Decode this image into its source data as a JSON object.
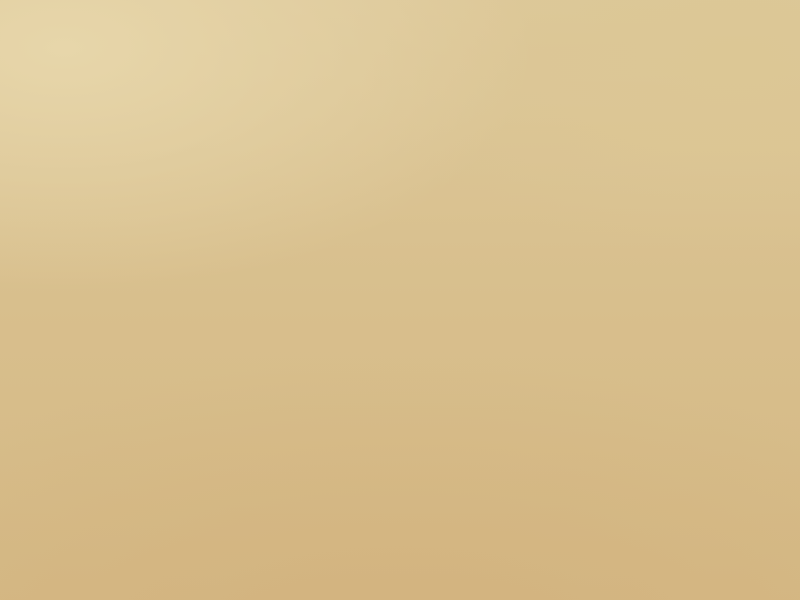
{
  "map": {
    "kind": "aerial-masterplan-rendering",
    "canvas": {
      "w": 800,
      "h": 600
    },
    "palette": {
      "sand": "#d9c290",
      "sand_light": "#e6d4a6",
      "sand_dark": "#c9ad7b",
      "road": "#8e8876",
      "road_light": "#9d947f",
      "track": "#bcae8e",
      "olive": "#74823e",
      "olive_dark": "#5c6b33",
      "lawn": "#8db83b",
      "lawn_bright": "#9cc44a",
      "lawn_pale": "#b9c47e",
      "tree": "#3a5322",
      "tree_dark": "#2c431c",
      "tree_mid": "#4b662c",
      "row_cream": "#e8e2bc",
      "row_shadow": "#a8a87b",
      "building_cream": "#e9e2bb",
      "building_shadow": "#b3a97e",
      "facility_white": "#f1ecd9",
      "court_green": "#5f7034",
      "glass_blue": "#41618c",
      "pool_blue": "#3ea2cf",
      "bloom_pink": "#c887b5",
      "bloom_red": "#a8452f",
      "rust": "#a96a3c",
      "island_green": "#7cab36",
      "shrubs": [
        "#6d7544",
        "#57633a",
        "#7d7a4e",
        "#4a5630",
        "#8a8050",
        "#9a6a40"
      ]
    },
    "desert_patches": [
      [
        640,
        420,
        150,
        140,
        "#cdb17e",
        0.55
      ],
      [
        190,
        515,
        260,
        90,
        "#cfb077",
        0.45
      ],
      [
        540,
        55,
        90,
        130,
        "#e3d2a2",
        0.6
      ],
      [
        765,
        290,
        40,
        220,
        "#cdb17e",
        0.5
      ],
      [
        0,
        330,
        150,
        180,
        "#e0cb9b",
        0.5
      ]
    ],
    "highway": {
      "rail": [
        37,
        0,
        8,
        600
      ],
      "road": [
        49,
        0,
        8,
        600
      ]
    },
    "interchange": {
      "ramps": [
        [
          -20,
          8,
          150,
          5,
          24
        ],
        [
          -22,
          28,
          145,
          5,
          12
        ],
        [
          -18,
          -4,
          125,
          4,
          38
        ],
        [
          -12,
          54,
          118,
          5,
          -16
        ],
        [
          2,
          74,
          100,
          4,
          -33
        ],
        [
          52,
          32,
          70,
          6,
          8
        ]
      ],
      "loops": [
        [
          3,
          12,
          30
        ],
        [
          15,
          40,
          28
        ]
      ]
    },
    "arterial": {
      "rect": [
        58,
        55,
        692,
        10
      ],
      "rot": -0.5
    },
    "roundabout": {
      "x": 718,
      "y": 27,
      "outer": 60,
      "inner": 42,
      "trees": 10
    },
    "roads": [
      [
        157,
        0,
        5,
        58,
        "road",
        0
      ],
      [
        487,
        0,
        5,
        72,
        "road",
        0
      ],
      [
        744,
        0,
        5,
        30,
        "road",
        0
      ],
      [
        775,
        51,
        25,
        6,
        "road",
        0
      ],
      [
        0,
        297,
        38,
        6,
        "road",
        0
      ],
      [
        0,
        497,
        800,
        7,
        "road",
        0
      ],
      [
        157,
        58,
        5,
        442,
        "road_light",
        0
      ],
      [
        328,
        76,
        4,
        424,
        "road_light",
        0
      ],
      [
        487,
        72,
        5,
        428,
        "road_light",
        0
      ],
      [
        581,
        92,
        3,
        192,
        "road_light",
        0
      ],
      [
        643,
        66,
        4,
        218,
        "road_light",
        0
      ],
      [
        698,
        282,
        3,
        218,
        "road_light",
        0
      ],
      [
        750,
        80,
        5,
        426,
        "road",
        1.8
      ],
      [
        157,
        209,
        336,
        4,
        "road_light",
        0
      ],
      [
        487,
        218,
        268,
        4,
        "road_light",
        0
      ],
      [
        157,
        339,
        336,
        5,
        "road_light",
        0
      ],
      [
        487,
        279,
        268,
        5,
        "road_light",
        0
      ]
    ],
    "south_tracks": [
      [
        175,
        505,
        2,
        95
      ],
      [
        331,
        505,
        2,
        95
      ]
    ],
    "islands": [
      [
        486,
        338,
        10
      ],
      [
        578,
        278,
        10
      ],
      [
        325,
        338,
        8
      ]
    ],
    "medians": [
      [
        758,
        474,
        5,
        24,
        2
      ]
    ],
    "pads": [
      [
        160,
        86,
        204,
        130
      ],
      [
        348,
        90,
        116,
        122
      ],
      [
        450,
        94,
        92,
        104
      ],
      [
        578,
        84,
        184,
        138
      ],
      [
        156,
        206,
        184,
        146
      ],
      [
        332,
        210,
        252,
        140
      ],
      [
        580,
        208,
        182,
        140
      ],
      [
        158,
        338,
        176,
        156
      ],
      [
        328,
        344,
        186,
        134
      ],
      [
        498,
        340,
        270,
        154
      ],
      [
        736,
        86,
        18,
        416
      ],
      [
        160,
        462,
        606,
        32
      ],
      [
        164,
        84,
        592,
        16
      ]
    ],
    "tree_lines": [
      [
        80,
        46,
        660,
        10,
        70
      ],
      [
        80,
        66,
        660,
        12,
        80
      ],
      [
        165,
        84,
        590,
        14,
        90
      ],
      [
        160,
        484,
        610,
        14,
        90
      ],
      [
        165,
        464,
        600,
        16,
        60
      ],
      [
        157,
        328,
        335,
        24,
        55
      ],
      [
        487,
        268,
        268,
        24,
        50
      ],
      [
        733,
        85,
        40,
        415,
        80
      ],
      [
        149,
        62,
        18,
        438,
        55
      ],
      [
        479,
        74,
        18,
        426,
        50
      ],
      [
        321,
        78,
        16,
        422,
        45
      ],
      [
        575,
        70,
        12,
        214,
        24
      ],
      [
        637,
        66,
        12,
        218,
        24
      ],
      [
        58,
        128,
        102,
        370,
        80
      ],
      [
        330,
        346,
        182,
        132,
        60
      ],
      [
        336,
        248,
        132,
        58,
        26
      ],
      [
        160,
        506,
        620,
        16,
        36
      ],
      [
        58,
        62,
        10,
        430,
        26
      ],
      [
        700,
        284,
        12,
        214,
        22
      ]
    ],
    "shrub_fields": [
      [
        0,
        0,
        290,
        50,
        50
      ],
      [
        565,
        0,
        235,
        46,
        40
      ],
      [
        60,
        52,
        700,
        34,
        60
      ],
      [
        0,
        60,
        38,
        540,
        50
      ],
      [
        58,
        64,
        104,
        62,
        22
      ],
      [
        758,
        64,
        42,
        440,
        36
      ],
      [
        162,
        508,
        638,
        92,
        110
      ],
      [
        0,
        508,
        162,
        92,
        36
      ],
      [
        536,
        82,
        48,
        132,
        24
      ]
    ],
    "park_strip": {
      "base": [
        58,
        126,
        102,
        372
      ],
      "lawns": [
        [
          60,
          130,
          44,
          52,
          "#b9c47e"
        ],
        [
          62,
          196,
          38,
          58,
          "#8db83b"
        ],
        [
          58,
          278,
          44,
          62,
          "#93bb40"
        ],
        [
          60,
          386,
          48,
          96,
          "#8db83b"
        ],
        [
          100,
          150,
          30,
          40,
          "#a4bb5e"
        ]
      ],
      "track": [
        70,
        296,
        32,
        28
      ],
      "pond": [
        74,
        416,
        12,
        18
      ],
      "path": [
        99,
        128,
        3,
        368
      ]
    },
    "townhouse_blocks": [
      {
        "r": [
          167,
          92,
          94,
          114
        ],
        "streets": [
          0.34,
          0.68
        ],
        "hstreets": [
          0.48
        ],
        "courts": [
          [
            0.4,
            0.42,
            0.22,
            0.16
          ]
        ],
        "pools": [
          [
            0.52,
            0.5
          ]
        ]
      },
      {
        "r": [
          354,
          96,
          104,
          110
        ],
        "streets": [
          0.52
        ],
        "hstreets": [],
        "courts": [
          [
            0.4,
            0.28,
            0.2,
            0.4
          ]
        ],
        "pools": [
          [
            0.48,
            0.46
          ]
        ]
      },
      {
        "r": [
          584,
          90,
          172,
          126
        ],
        "streets": [
          0.25,
          0.51,
          0.77
        ],
        "hstreets": [
          0.5
        ],
        "courts": [
          [
            0.3,
            0.42,
            0.12,
            0.2
          ],
          [
            0.6,
            0.22,
            0.1,
            0.18
          ]
        ],
        "pools": [
          [
            0.34,
            0.5
          ],
          [
            0.64,
            0.3
          ],
          [
            0.45,
            0.68
          ]
        ]
      },
      {
        "r": [
          162,
          212,
          58,
          132
        ],
        "streets": [
          0.5
        ],
        "hstreets": [
          0.33,
          0.66
        ],
        "courts": [],
        "pools": []
      },
      {
        "r": [
          167,
          344,
          162,
          144
        ],
        "streets": [
          0.3,
          0.63
        ],
        "hstreets": [
          0.44
        ],
        "courts": [
          [
            0.18,
            0.28,
            0.16,
            0.2
          ]
        ],
        "pools": [
          [
            0.56,
            0.34
          ]
        ]
      },
      {
        "r": [
          504,
          344,
          260,
          146
        ],
        "streets": [
          0.19,
          0.4,
          0.61,
          0.82
        ],
        "hstreets": [
          0.46
        ],
        "courts": [
          [
            0.29,
            0.52,
            0.1,
            0.2
          ],
          [
            0.55,
            0.18,
            0.1,
            0.18
          ]
        ],
        "pools": [
          [
            0.17,
            0.4
          ],
          [
            0.46,
            0.2
          ],
          [
            0.33,
            0.72
          ],
          [
            0.7,
            0.5
          ]
        ]
      }
    ],
    "apartment_blocks": [
      {
        "r": [
          264,
          102,
          94,
          90
        ],
        "cols": 2,
        "rows": 2,
        "inner": "court"
      },
      {
        "r": [
          458,
          100,
          78,
          92
        ],
        "cols": 2,
        "rows": 2,
        "inner": "court"
      },
      {
        "r": [
          222,
          212,
          112,
          134
        ],
        "cols": 2,
        "rows": 2,
        "inner": "court"
      },
      {
        "r": [
          338,
          216,
          118,
          46
        ],
        "cols": 3,
        "rows": 1,
        "inner": "court"
      },
      {
        "r": [
          460,
          212,
          118,
          62
        ],
        "cols": 3,
        "rows": 1,
        "inner": "court"
      },
      {
        "r": [
          460,
          286,
          118,
          54
        ],
        "cols": 3,
        "rows": 1,
        "inner": "court"
      },
      {
        "r": [
          588,
          230,
          52,
          48
        ],
        "cols": 1,
        "rows": 1,
        "inner": "glass"
      },
      {
        "r": [
          588,
          290,
          52,
          50
        ],
        "cols": 1,
        "rows": 1,
        "inner": "glass"
      },
      {
        "r": [
          645,
          220,
          42,
          52
        ],
        "cols": 1,
        "rows": 1,
        "inner": "court"
      },
      {
        "r": [
          645,
          288,
          42,
          50
        ],
        "cols": 1,
        "rows": 1,
        "inner": "court"
      },
      {
        "r": [
          700,
          218,
          40,
          54
        ],
        "cols": 1,
        "rows": 1,
        "inner": "court"
      },
      {
        "r": [
          700,
          292,
          40,
          48
        ],
        "cols": 1,
        "rows": 1,
        "inner": "court"
      }
    ],
    "campus_blocks": [
      {
        "r": [
          336,
          354,
          132,
          48
        ],
        "cols": 4,
        "rows": 1,
        "inner": "glass"
      },
      {
        "r": [
          470,
          360,
          36,
          40
        ],
        "cols": 1,
        "rows": 1,
        "inner": "glass"
      },
      {
        "r": [
          348,
          410,
          102,
          54
        ],
        "cols": 3,
        "rows": 1,
        "inner": "glass"
      },
      {
        "r": [
          458,
          410,
          38,
          48
        ],
        "cols": 1,
        "rows": 1,
        "inner": "glass"
      }
    ],
    "slab_rows": [
      {
        "r": [
          338,
          298,
          124,
          40
        ],
        "n": 6
      }
    ],
    "central_park": {
      "pad": [
        336,
        252,
        130,
        52
      ],
      "lawns": [
        [
          340,
          256,
          28,
          40
        ],
        [
          372,
          258,
          34,
          40
        ],
        [
          410,
          258,
          30,
          40
        ],
        [
          444,
          260,
          18,
          36
        ],
        [
          252,
          262,
          30,
          26
        ]
      ],
      "bloom_pink": [
        [
          375,
          259
        ],
        [
          383,
          263
        ],
        [
          391,
          258
        ],
        [
          399,
          262
        ],
        [
          407,
          259
        ],
        [
          414,
          263
        ],
        [
          422,
          260
        ]
      ],
      "bloom_red": [
        [
          376,
          268
        ],
        [
          398,
          268
        ],
        [
          418,
          267
        ]
      ],
      "pavilions": [
        [
          352,
          272
        ],
        [
          388,
          286
        ],
        [
          424,
          270
        ]
      ]
    },
    "facilities": [
      [
        84,
        118,
        26,
        16
      ],
      [
        112,
        132,
        18,
        12
      ],
      [
        70,
        148,
        16,
        11
      ],
      [
        92,
        152,
        22,
        14
      ],
      [
        118,
        160,
        14,
        10
      ],
      [
        76,
        176,
        18,
        12
      ],
      [
        100,
        182,
        24,
        15
      ],
      [
        64,
        210,
        14,
        10
      ],
      [
        112,
        214,
        16,
        22
      ],
      [
        88,
        236,
        20,
        13
      ],
      [
        118,
        244,
        13,
        9
      ],
      [
        70,
        256,
        16,
        11
      ],
      [
        96,
        266,
        22,
        14
      ],
      [
        64,
        292,
        14,
        10
      ],
      [
        108,
        290,
        16,
        11
      ],
      [
        84,
        322,
        20,
        13
      ],
      [
        110,
        330,
        14,
        9
      ],
      [
        92,
        352,
        18,
        12
      ],
      [
        112,
        360,
        13,
        9
      ],
      [
        74,
        370,
        16,
        10
      ],
      [
        96,
        384,
        22,
        13
      ],
      [
        112,
        404,
        14,
        9
      ],
      [
        86,
        412,
        16,
        10
      ],
      [
        62,
        444,
        20,
        30
      ],
      [
        100,
        440,
        16,
        10
      ],
      [
        90,
        462,
        18,
        11
      ],
      [
        455,
        464,
        16,
        9
      ],
      [
        476,
        466,
        12,
        8
      ],
      [
        342,
        468,
        12,
        8
      ],
      [
        268,
        450,
        20,
        12
      ]
    ],
    "special_buildings": [
      [
        292,
        452,
        12,
        16,
        "rust"
      ]
    ],
    "villages": {
      "speckle": [
        {
          "r": [
            295,
            2,
            270,
            62
          ],
          "white": 90,
          "rust": 22,
          "green": 60,
          "grid": false
        },
        {
          "r": [
            652,
            4,
            86,
            38
          ],
          "white": 70,
          "rust": 0,
          "green": 8,
          "grid": true
        }
      ],
      "settlements": [
        [
          220,
          548,
          8,
          5
        ],
        [
          232,
          552,
          7,
          4
        ],
        [
          243,
          548,
          6,
          4
        ],
        [
          252,
          553,
          8,
          5
        ],
        [
          262,
          549,
          6,
          4
        ],
        [
          272,
          554,
          7,
          4
        ],
        [
          282,
          550,
          8,
          5
        ],
        [
          294,
          555,
          6,
          4
        ],
        [
          302,
          550,
          7,
          4
        ],
        [
          226,
          560,
          6,
          4
        ],
        [
          240,
          562,
          7,
          4
        ],
        [
          256,
          564,
          6,
          4
        ],
        [
          270,
          562,
          7,
          4
        ],
        [
          288,
          562,
          6,
          4
        ],
        [
          300,
          564,
          6,
          4
        ],
        [
          496,
          560,
          8,
          5
        ],
        [
          507,
          562,
          6,
          4
        ],
        [
          500,
          568,
          7,
          4
        ],
        [
          510,
          569,
          5,
          4
        ]
      ]
    }
  }
}
